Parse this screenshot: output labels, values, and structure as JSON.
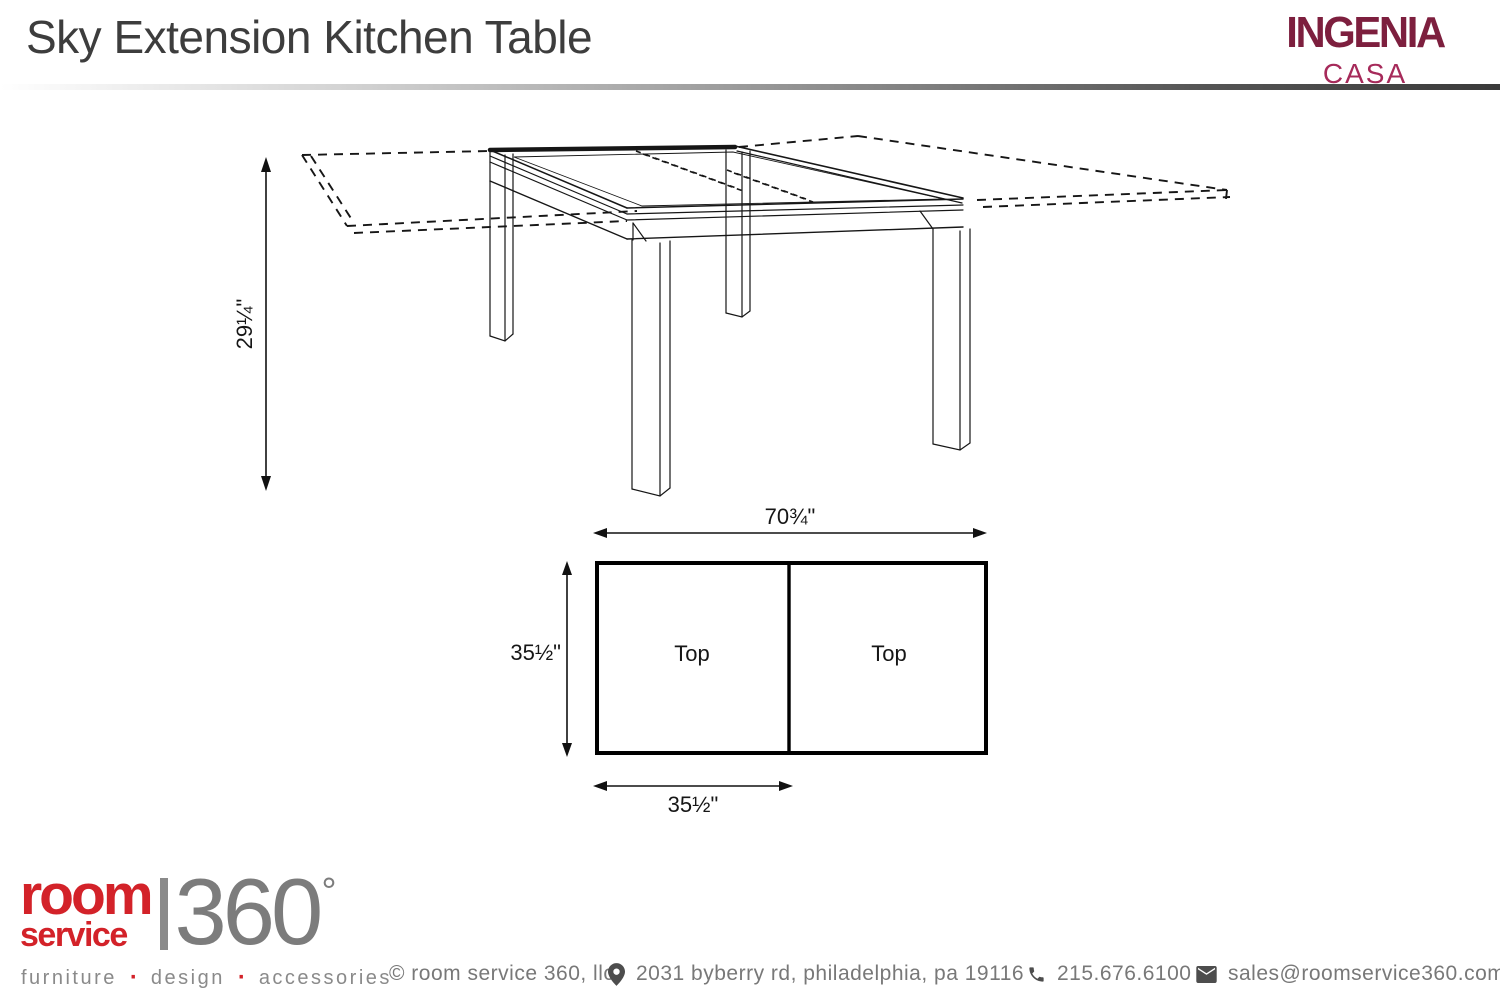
{
  "header": {
    "title": "Sky Extension Kitchen Table",
    "brand_name": "INGENIA",
    "brand_sub": "CASA"
  },
  "diagram": {
    "height_label": "29¼\"",
    "overall_width_label": "70¾\"",
    "depth_label": "35½\"",
    "half_top_width_label": "35½\"",
    "plan_left_panel_label": "Top",
    "plan_right_panel_label": "Top"
  },
  "footer": {
    "logo_line1": "room",
    "logo_line2": "service",
    "logo_number": "360",
    "logo_degree": "°",
    "tagline": [
      "furniture",
      "design",
      "accessories"
    ],
    "tagline_separator": "·",
    "copyright": "© room service 360, llc",
    "address": "2031 byberry rd, philadelphia, pa 19116",
    "phone": "215.676.6100",
    "email": "sales@roomservice360.com"
  },
  "colors": {
    "brand_maroon": "#7d1f3e",
    "brand_rose": "#a62a5a",
    "logo_red": "#d32229",
    "logo_gray": "#7c7c7c",
    "title_gray": "#3d3d3d",
    "footer_text_gray": "#787878",
    "line_black": "#161616"
  }
}
